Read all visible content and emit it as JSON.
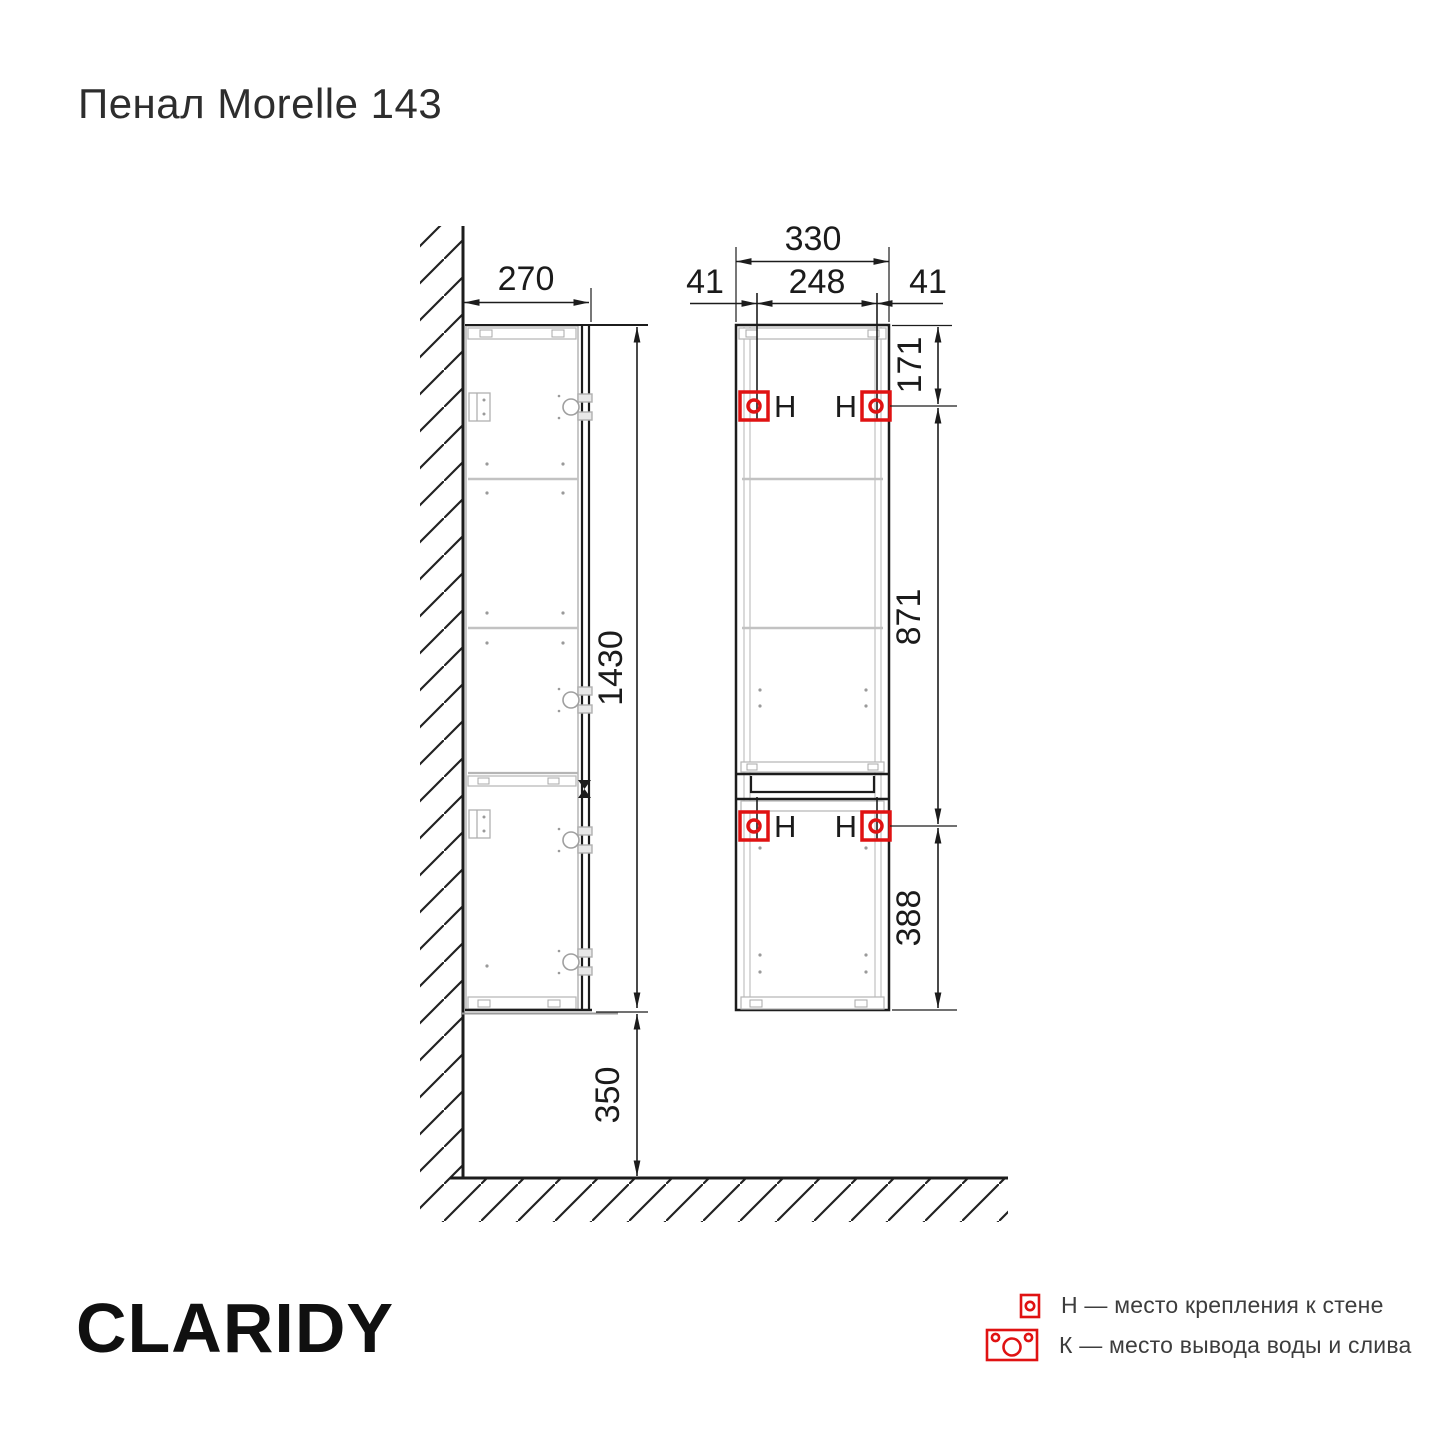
{
  "page": {
    "title": "Пенал Morelle 143",
    "brand": "CLARIDY"
  },
  "drawing": {
    "side_view": {
      "depth_mm": "270",
      "height_mm": "1430",
      "floor_clearance_mm": "350"
    },
    "front_view": {
      "overall_width_mm": "330",
      "left_mount_inset_mm": "41",
      "mount_spacing_mm": "248",
      "right_mount_inset_mm": "41",
      "top_to_mount_mm": "171",
      "mount_to_mount_mm": "871",
      "mount_to_bottom_mm": "388",
      "mount_label": "Н"
    },
    "colors": {
      "line": "#1c1c1c",
      "light_line": "#b9b9b9",
      "accent_red": "#e01212"
    }
  },
  "legend": {
    "items": [
      {
        "key": "Н",
        "text": "Н — место крепления к стене"
      },
      {
        "key": "К",
        "text": "К — место вывода воды и слива"
      }
    ]
  }
}
